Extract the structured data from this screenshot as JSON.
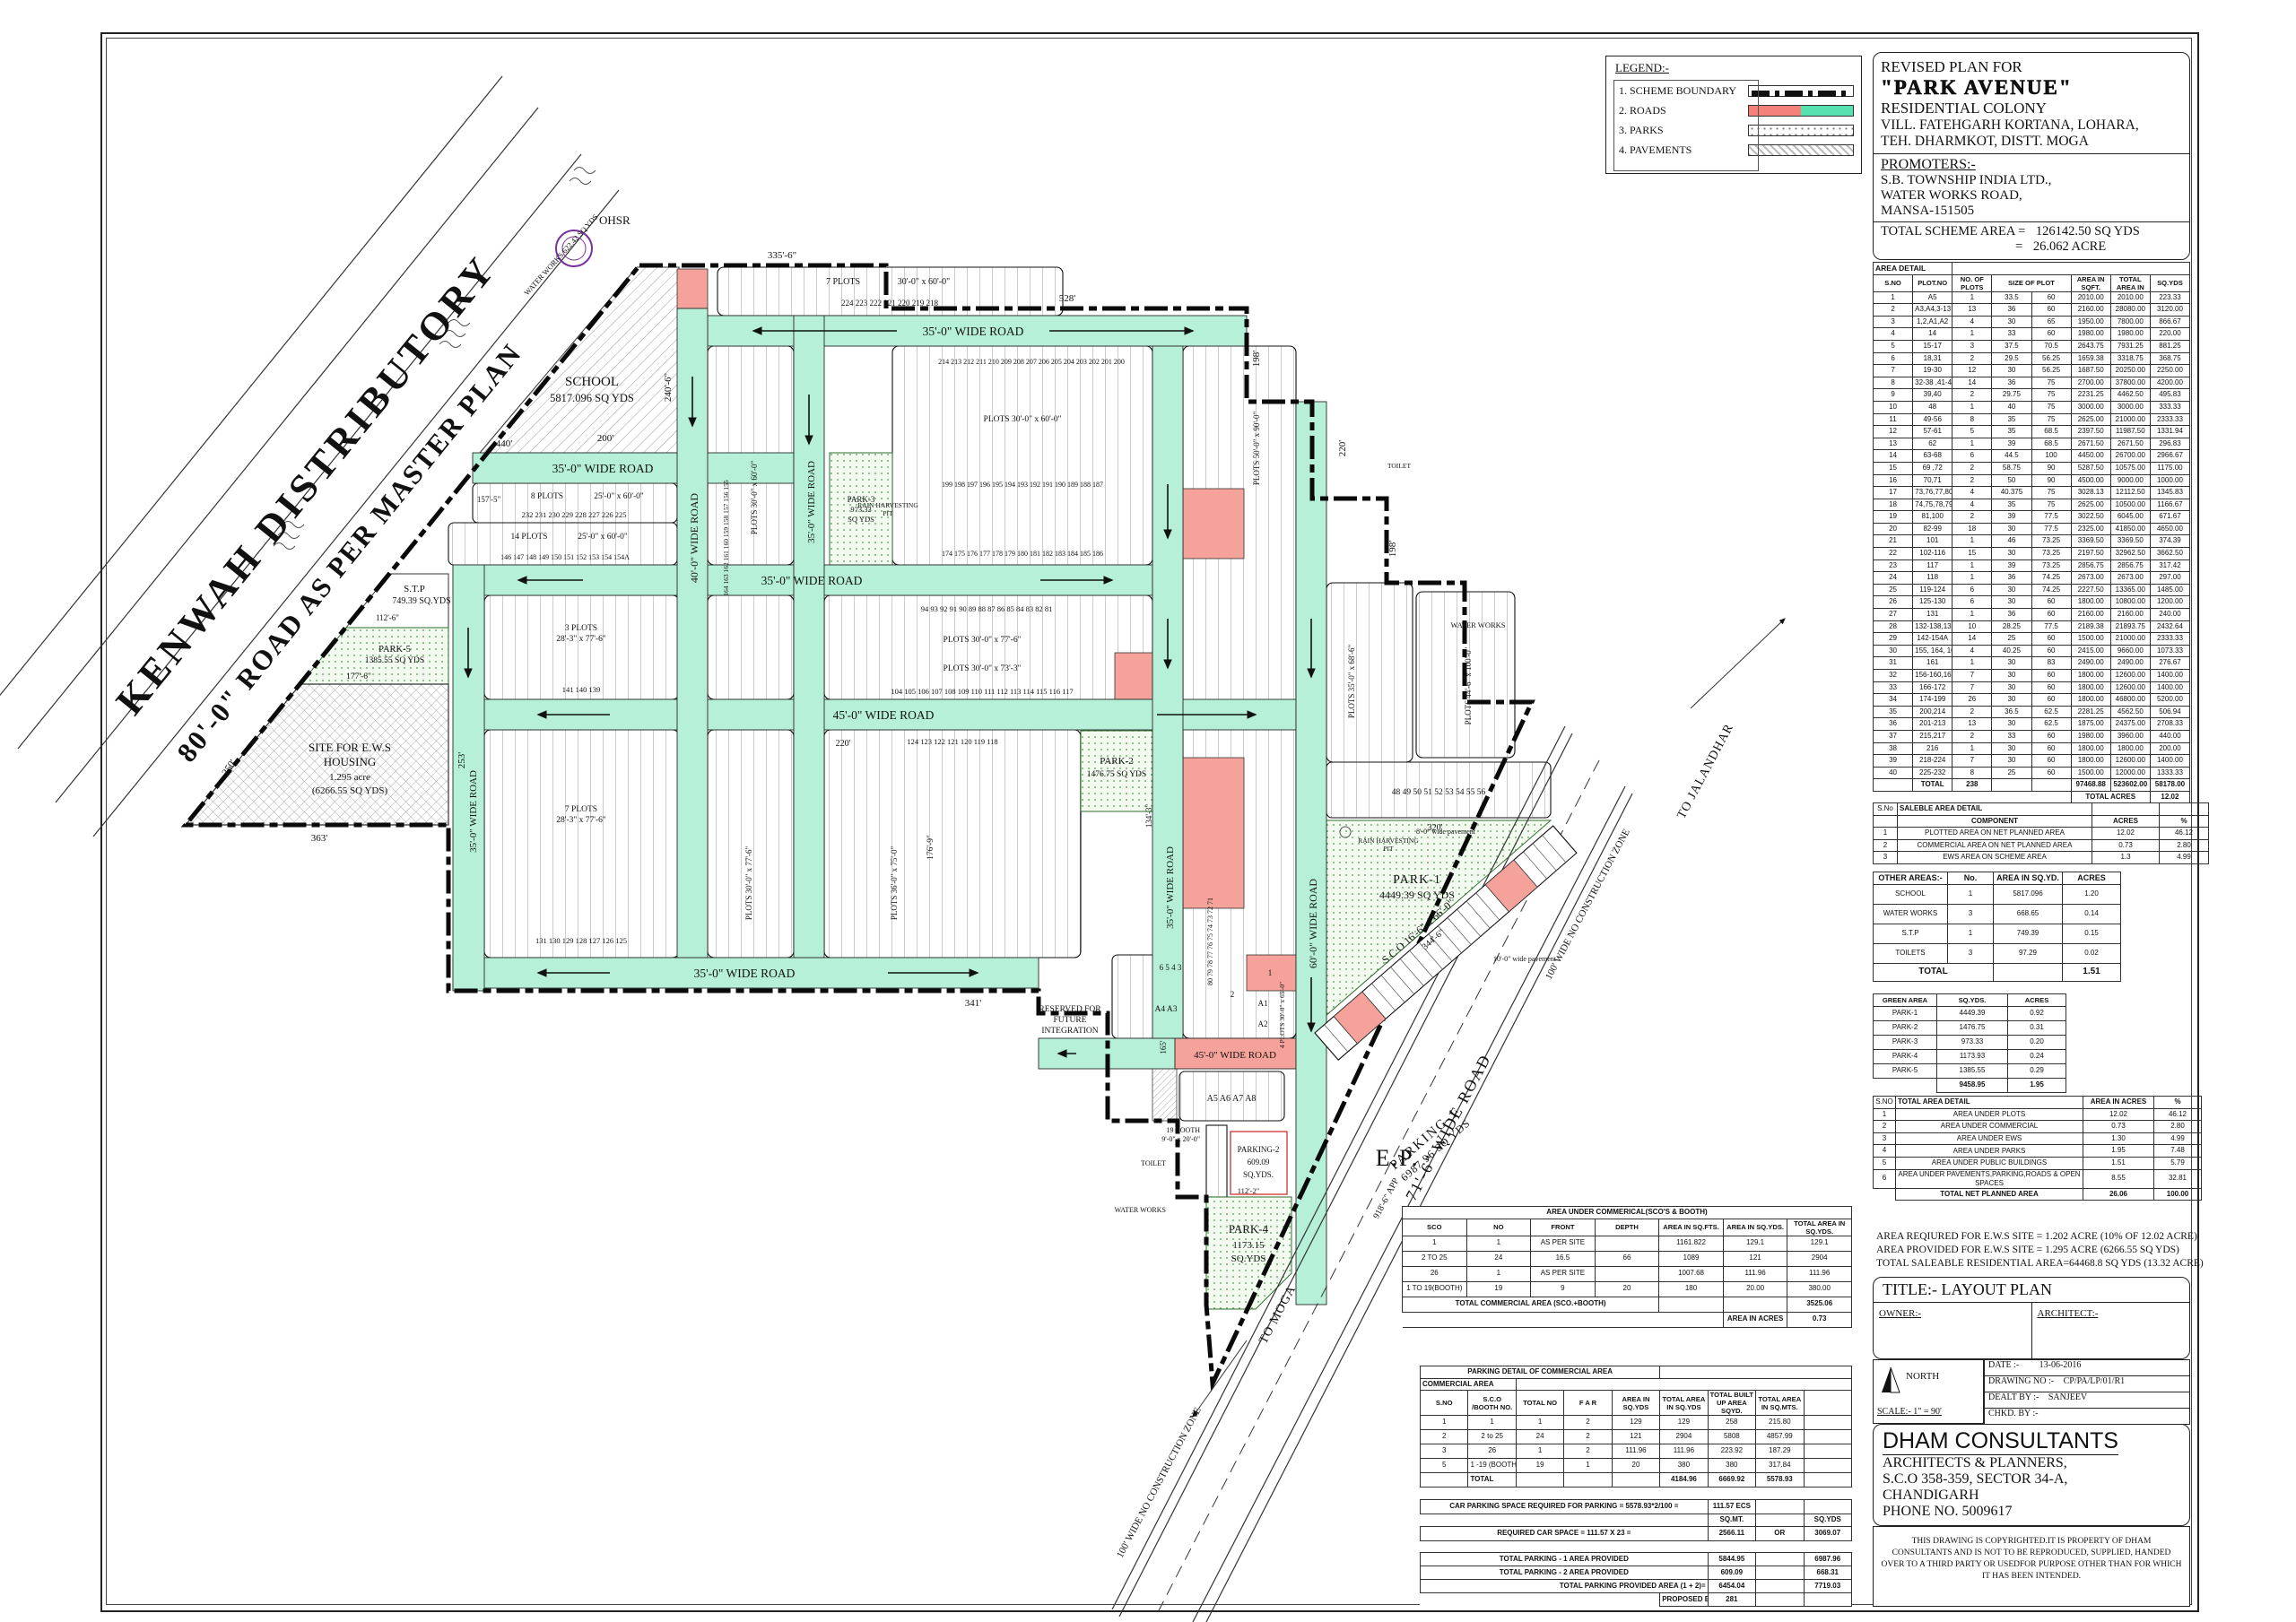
{
  "colors": {
    "road_teal": "#b6f0d9",
    "salmon": "#f4a29a",
    "park_dot": "#4d9c4d",
    "red_text": "#cc1111",
    "purple": "#7a2f9e"
  },
  "legend": {
    "title": "LEGEND:-",
    "items": [
      {
        "label": "1.  SCHEME BOUNDARY",
        "swatch": "boundary"
      },
      {
        "label": "2.  ROADS",
        "swatch": "roads"
      },
      {
        "label": "3.  PARKS",
        "swatch": "parks"
      },
      {
        "label": "4.  PAVEMENTS",
        "swatch": "pavements"
      }
    ]
  },
  "title_block": {
    "line1": "REVISED  PLAN FOR",
    "name": "\"PARK AVENUE\"",
    "line3": "RESIDENTIAL COLONY",
    "line4": "VILL. FATEHGARH KORTANA, LOHARA,",
    "line5": "TEH. DHARMKOT, DISTT. MOGA",
    "promoters_label": "PROMOTERS:-",
    "promoter1": "S.B. TOWNSHIP INDIA LTD.,",
    "promoter2": "WATER WORKS ROAD,",
    "promoter3": "MANSA-151505",
    "scheme_area_label": "TOTAL SCHEME AREA   =",
    "scheme_area_val1": "126142.50 SQ YDS",
    "scheme_area_eq": "=",
    "scheme_area_val2": "26.062 ACRE"
  },
  "area_detail": {
    "title": "AREA DETAIL",
    "headers": [
      "S.NO",
      "PLOT.NO",
      "NO. OF PLOTS",
      "SIZE OF PLOT",
      "",
      "AREA IN SQFT.",
      "TOTAL AREA IN",
      "SQ.YDS"
    ],
    "rows": [
      [
        "1",
        "A5",
        "1",
        "33.5",
        "60",
        "2010.00",
        "2010.00",
        "223.33"
      ],
      [
        "2",
        "A3,A4,3-13",
        "13",
        "36",
        "60",
        "2160.00",
        "28080.00",
        "3120.00"
      ],
      [
        "3",
        "1,2,A1,A2",
        "4",
        "30",
        "65",
        "1950.00",
        "7800.00",
        "866.67"
      ],
      [
        "4",
        "14",
        "1",
        "33",
        "60",
        "1980.00",
        "1980.00",
        "220.00"
      ],
      [
        "5",
        "15-17",
        "3",
        "37.5",
        "70.5",
        "2643.75",
        "7931.25",
        "881.25"
      ],
      [
        "6",
        "18,31",
        "2",
        "29.5",
        "56.25",
        "1659.38",
        "3318.75",
        "368.75"
      ],
      [
        "7",
        "19-30",
        "12",
        "30",
        "56.25",
        "1687.50",
        "20250.00",
        "2250.00"
      ],
      [
        "8",
        "32-38 ,41-47",
        "14",
        "36",
        "75",
        "2700.00",
        "37800.00",
        "4200.00"
      ],
      [
        "9",
        "39,40",
        "2",
        "29.75",
        "75",
        "2231.25",
        "4462.50",
        "495.83"
      ],
      [
        "10",
        "48",
        "1",
        "40",
        "75",
        "3000.00",
        "3000.00",
        "333.33"
      ],
      [
        "11",
        "49-56",
        "8",
        "35",
        "75",
        "2625.00",
        "21000.00",
        "2333.33"
      ],
      [
        "12",
        "57-61",
        "5",
        "35",
        "68.5",
        "2397.50",
        "11987.50",
        "1331.94"
      ],
      [
        "13",
        "62",
        "1",
        "39",
        "68.5",
        "2671.50",
        "2671.50",
        "296.83"
      ],
      [
        "14",
        "63-68",
        "6",
        "44.5",
        "100",
        "4450.00",
        "26700.00",
        "2966.67"
      ],
      [
        "15",
        "69 ,72",
        "2",
        "58.75",
        "90",
        "5287.50",
        "10575.00",
        "1175.00"
      ],
      [
        "16",
        "70,71",
        "2",
        "50",
        "90",
        "4500.00",
        "9000.00",
        "1000.00"
      ],
      [
        "17",
        "73,76,77,80",
        "4",
        "40.375",
        "75",
        "3028.13",
        "12112.50",
        "1345.83"
      ],
      [
        "18",
        "74,75,78,79",
        "4",
        "35",
        "75",
        "2625.00",
        "10500.00",
        "1166.67"
      ],
      [
        "19",
        "81,100",
        "2",
        "39",
        "77.5",
        "3022.50",
        "6045.00",
        "671.67"
      ],
      [
        "20",
        "82-99",
        "18",
        "30",
        "77.5",
        "2325.00",
        "41850.00",
        "4650.00"
      ],
      [
        "21",
        "101",
        "1",
        "46",
        "73.25",
        "3369.50",
        "3369.50",
        "374.39"
      ],
      [
        "22",
        "102-116",
        "15",
        "30",
        "73.25",
        "2197.50",
        "32962.50",
        "3662.50"
      ],
      [
        "23",
        "117",
        "1",
        "39",
        "73.25",
        "2856.75",
        "2856.75",
        "317.42"
      ],
      [
        "24",
        "118",
        "1",
        "36",
        "74.25",
        "2673.00",
        "2673.00",
        "297.00"
      ],
      [
        "25",
        "119-124",
        "6",
        "30",
        "74.25",
        "2227.50",
        "13365.00",
        "1485.00"
      ],
      [
        "26",
        "125-130",
        "6",
        "30",
        "60",
        "1800.00",
        "10800.00",
        "1200.00"
      ],
      [
        "27",
        "131",
        "1",
        "36",
        "60",
        "2160.00",
        "2160.00",
        "240.00"
      ],
      [
        "28",
        "132-138,139-141",
        "10",
        "28.25",
        "77.5",
        "2189.38",
        "21893.75",
        "2432.64"
      ],
      [
        "29",
        "142-154A",
        "14",
        "25",
        "60",
        "1500.00",
        "21000.00",
        "2333.33"
      ],
      [
        "30",
        "155, 164, 165, 173",
        "4",
        "40.25",
        "60",
        "2415.00",
        "9660.00",
        "1073.33"
      ],
      [
        "31",
        "161",
        "1",
        "30",
        "83",
        "2490.00",
        "2490.00",
        "276.67"
      ],
      [
        "32",
        "156-160,162,163",
        "7",
        "30",
        "60",
        "1800.00",
        "12600.00",
        "1400.00"
      ],
      [
        "33",
        "166-172",
        "7",
        "30",
        "60",
        "1800.00",
        "12600.00",
        "1400.00"
      ],
      [
        "34",
        "174-199",
        "26",
        "30",
        "60",
        "1800.00",
        "46800.00",
        "5200.00"
      ],
      [
        "35",
        "200,214",
        "2",
        "36.5",
        "62.5",
        "2281.25",
        "4562.50",
        "506.94"
      ],
      [
        "36",
        "201-213",
        "13",
        "30",
        "62.5",
        "1875.00",
        "24375.00",
        "2708.33"
      ],
      [
        "37",
        "215,217",
        "2",
        "33",
        "60",
        "1980.00",
        "3960.00",
        "440.00"
      ],
      [
        "38",
        "216",
        "1",
        "30",
        "60",
        "1800.00",
        "1800.00",
        "200.00"
      ],
      [
        "39",
        "218-224",
        "7",
        "30",
        "60",
        "1800.00",
        "12600.00",
        "1400.00"
      ],
      [
        "40",
        "225-232",
        "8",
        "25",
        "60",
        "1500.00",
        "12000.00",
        "1333.33"
      ]
    ],
    "total_label": "TOTAL",
    "total_plots": "238",
    "total_sqft": "97468.88",
    "total_area": "523602.00",
    "total_sqyds": "58178.00",
    "total_acres_label": "TOTAL ACRES",
    "total_acres": "12.02"
  },
  "saleable": {
    "sno_label": "S.No",
    "title": "SALEBLE AREA DETAIL",
    "component": "COMPONENT",
    "acres": "ACRES",
    "pct": "%",
    "rows": [
      [
        "1",
        "PLOTTED AREA ON NET PLANNED AREA",
        "12.02",
        "46.12"
      ],
      [
        "2",
        "COMMERCIAL AREA ON NET PLANNED AREA",
        "0.73",
        "2.80"
      ],
      [
        "3",
        "EWS AREA ON SCHEME AREA",
        "1.3",
        "4.99"
      ]
    ]
  },
  "other_areas": {
    "title": "OTHER AREAS:-",
    "no": "No.",
    "area": "AREA IN SQ.YD.",
    "acres": "ACRES",
    "rows": [
      [
        "SCHOOL",
        "1",
        "5817.096",
        "1.20"
      ],
      [
        "WATER WORKS",
        "3",
        "668.65",
        "0.14"
      ],
      [
        "S.T.P",
        "1",
        "749.39",
        "0.15"
      ],
      [
        "TOILETS",
        "3",
        "97.29",
        "0.02"
      ]
    ],
    "total_label": "TOTAL",
    "total": "1.51"
  },
  "green_area": {
    "headers": [
      "GREEN AREA",
      "SQ.YDS.",
      "ACRES"
    ],
    "rows": [
      [
        "PARK-1",
        "4449.39",
        "0.92"
      ],
      [
        "PARK-2",
        "1476.75",
        "0.31"
      ],
      [
        "PARK-3",
        "973.33",
        "0.20"
      ],
      [
        "PARK-4",
        "1173.93",
        "0.24"
      ],
      [
        "PARK-5",
        "1385.55",
        "0.29"
      ]
    ],
    "total_sqyds": "9458.95",
    "total_acres": "1.95"
  },
  "total_area": {
    "sno": "S.NO",
    "title": "TOTAL AREA DETAIL",
    "acres": "AREA IN ACRES",
    "pct": "%",
    "rows": [
      [
        "1",
        "AREA UNDER PLOTS",
        "12.02",
        "46.12"
      ],
      [
        "2",
        "AREA UNDER COMMERCIAL",
        "0.73",
        "2.80"
      ],
      [
        "3",
        "AREA UNDER EWS",
        "1.30",
        "4.99"
      ],
      [
        "4",
        "AREA UNDER PARKS",
        "1.95",
        "7.48"
      ],
      [
        "5",
        "AREA UNDER PUBLIC BUILDINGS",
        "1.51",
        "5.79"
      ],
      [
        "6",
        "AREA UNDER PAVEMENTS,PARKING,ROADS & OPEN SPACES",
        "8.55",
        "32.81"
      ]
    ],
    "total_label": "TOTAL NET PLANNED AREA",
    "total_acres": "26.06",
    "total_pct": "100.00"
  },
  "ews_notes": [
    "AREA REQIURED FOR E.W.S SITE = 1.202 ACRE (10% OF 12.02 ACRE)",
    "AREA PROVIDED FOR E.W.S SITE = 1.295 ACRE (6266.55 SQ YDS)",
    "TOTAL SALEABLE RESIDENTIAL AREA=64468.8 SQ YDS (13.32 ACRE)"
  ],
  "title_plate": {
    "title": "TITLE:-  LAYOUT   PLAN",
    "owner": "OWNER:-",
    "architect": "ARCHITECT:-"
  },
  "info": {
    "north": "NORTH",
    "scale": "SCALE:-  1\" = 90'",
    "date_label": "DATE :-",
    "date": "13-06-2016",
    "dwg_label": "DRAWING NO :-",
    "dwg": "CP/PA/LP/01/R1",
    "dealt_label": "DEALT BY :-",
    "dealt": "SANJEEV",
    "chkd_label": "CHKD. BY :-",
    "chkd": ""
  },
  "firm": {
    "name": "DHAM CONSULTANTS",
    "line2": "ARCHITECTS & PLANNERS,",
    "line3": "S.C.O 358-359, SECTOR 34-A,",
    "line4": "CHANDIGARH",
    "line5": "PHONE NO. 5009617"
  },
  "copyright": "THIS DRAWING IS COPYRIGHTED.IT IS PROPERTY OF DHAM CONSULTANTS AND IS NOT TO BE REPRODUCED, SUPPLIED, HANDED OVER TO A THIRD PARTY OR USEDFOR PURPOSE OTHER THAN FOR WHICH IT HAS BEEN INTENDED.",
  "commercial_table": {
    "title": "AREA UNDER COMMERICAL(SCO'S & BOOTH)",
    "headers": [
      "SCO",
      "NO",
      "FRONT",
      "DEPTH",
      "AREA IN SQ.FTS.",
      "AREA IN SQ.YDS.",
      "TOTAL AREA IN SQ.YDS."
    ],
    "rows": [
      [
        "1",
        "1",
        "AS PER SITE",
        "",
        "1161.822",
        "129.1",
        "129.1"
      ],
      [
        "2 TO 25",
        "24",
        "16.5",
        "66",
        "1089",
        "121",
        "2904"
      ],
      [
        "26",
        "1",
        "AS PER SITE",
        "",
        "1007.68",
        "111.96",
        "111.96"
      ],
      [
        "1  TO 19(BOOTH)",
        "19",
        "9",
        "20",
        "180",
        "20.00",
        "380.00"
      ]
    ],
    "total_label": "TOTAL COMMERCIAL AREA (SCO.+BOOTH)",
    "total": "3525.06",
    "acres_label": "AREA IN ACRES",
    "acres": "0.73"
  },
  "parking_table": {
    "title": "PARKING DETAIL OF COMMERCIAL AREA",
    "subtitle": "COMMERCIAL AREA",
    "headers": [
      "S.NO",
      "S.C.O /BOOTH NO.",
      "TOTAL NO",
      "F A R",
      "AREA IN SQ.YDS",
      "TOTAL AREA IN SQ.YDS",
      "TOTAL BUILT UP AREA SQYD.",
      "TOTAL AREA IN SQ.MTS.",
      ""
    ],
    "rows": [
      [
        "1",
        "1",
        "1",
        "2",
        "129",
        "129",
        "258",
        "215.80",
        ""
      ],
      [
        "2",
        "2 to 25",
        "24",
        "2",
        "121",
        "2904",
        "5808",
        "4857.99",
        ""
      ],
      [
        "3",
        "26",
        "1",
        "2",
        "111.96",
        "111.96",
        "223.92",
        "187.29",
        ""
      ],
      [
        "5",
        "1 -19 (BOOTH)",
        "19",
        "1",
        "20",
        "380",
        "380",
        "317.84",
        ""
      ]
    ],
    "total_label": "TOTAL",
    "total_area": "4184.96",
    "total_builtup": "6669.92",
    "total_sqmts": "5578.93",
    "car_label": "CAR PARKING SPACE REQUIRED FOR PARKING = 5578.93*2/100 =",
    "car_val": "111.57 ECS",
    "sqmt": "SQ.MT.",
    "sqyds": "SQ.YDS",
    "req_label": "REQUIRED CAR SPACE = 111.57 X 23 =",
    "req_val": "2566.11",
    "or": "OR",
    "req_val2": "3069.07",
    "p1_label": "TOTAL PARKING - 1 AREA PROVIDED",
    "p1_a": "5844.95",
    "p1_b": "6987.96",
    "p2_label": "TOTAL PARKING - 2 AREA PROVIDED",
    "p2_a": "609.09",
    "p2_b": "668.31",
    "pt_label": "TOTAL PARKING PROVIDED  AREA (1 + 2)=",
    "pt_a": "6454.04",
    "pt_b": "7719.03",
    "ecs_label": "PROPOSED E.C.S",
    "ecs": "281"
  },
  "map": {
    "kenwah1": "KENWAH DISTRIBUTORY",
    "kenwah2": "80'-0\" ROAD AS PER MASTER PLAN",
    "ohsr": "OHSR",
    "ww_small": "WATER WORKS 622.42 SQ YDS",
    "school1": "SCHOOL",
    "school2": "5817.096 SQ YDS",
    "stp1": "S.T.P",
    "stp2": "749.39 SQ.YDS",
    "park5_1": "PARK-5",
    "park5_2": "1385.55 SQ YDS",
    "ews1": "SITE FOR E.W.S",
    "ews2": "HOUSING",
    "ews3": "1.295 acre",
    "ews4": "(6266.55 SQ YDS)",
    "park3_1": "PARK-3",
    "park3_2": "973.33",
    "park3_3": "SQ YDS",
    "park2_1": "PARK-2",
    "park2_2": "1476.75 SQ YDS",
    "park1_1": "PARK-1",
    "park1_2": "4449.39 SQ YDS",
    "park4_1": "PARK-4",
    "park4_2": "1173.15",
    "park4_3": "SQ.YDS",
    "parking1_1": "PARKING-1",
    "parking1_2": "6987.96 SQ YDS",
    "parking2_1": "PARKING-2",
    "parking2_2": "609.09",
    "parking2_3": "SQ.YDS.",
    "rain1": "RAIN HARVESTING",
    "rain2": "PIT",
    "road35": "35'-0\" WIDE ROAD",
    "road40": "40'-0\" WIDE ROAD",
    "road45": "45'-0\" WIDE ROAD",
    "road60": "60'-0\" WIDE ROAD",
    "road71": "71'-6\" WIDE ROAD",
    "ncz": "100' WIDE NO CONSTRUCTION ZONE",
    "to_jal": "TO JALANDHAR",
    "to_moga": "TO MOGA",
    "ep": "E.P.",
    "res1": "RESERVED FOR",
    "res2": "FUTURE",
    "res3": "INTEGRATION",
    "sco_label": "S C O   16'-6\" x 66'-0\"",
    "booth1": "19 BOOTH",
    "booth2": "9'-0\" x 20'-0\"",
    "toilet": "TOILET",
    "water_works": "WATER WORKS",
    "b1": "7 PLOTS",
    "b1s": "30'-0\" x 60'-0\"",
    "b2": "8 PLOTS",
    "b2s": "25'-0\" x 60'-0\"",
    "b3": "14 PLOTS",
    "b3s": "25'-0\" x 60'-0\"",
    "b4": "3 PLOTS",
    "b4s": "28'-3\" x 77'-6\"",
    "b5": "7 PLOTS",
    "b5s": "28'-3\" x 77'-6\"",
    "bp1": "PLOTS 30'-0\" x 60'-0\"",
    "bp2": "PLOTS 30'-0\" x 77'-6\"",
    "bp3": "PLOTS 30'-0\" x 73'-3\"",
    "bp4": "PLOTS 36'-0\" x 75'-0\"",
    "bp5": "4 PLOTS 30'-0\" x 65'-0\"",
    "bp6": "PLOTS 50'-0\" x 90'-0\"",
    "bp7": "PLOTS 35'-0\" x 68'-6\"",
    "bp8": "PLOTS 44'-6\" x 100'-0\"",
    "pav8": "8'-0\" wide pavement",
    "pav10": "10'-0\" wide pavement",
    "nums": {
      "n218": "224   223   222   221   220   219   218",
      "n225": "232   231   230   229   228   227   226   225",
      "n142": "146  147  148  149  150  151  152  153  154  154A",
      "n174": "174  175  176  177  178  179  180  181  182  183  184  185  186",
      "n199": "199  198  197  196  195  194  193  192  191  190  189  188  187",
      "n201": "214  213  212  211  210  209  208  207  206  205  204  203  202  201  200",
      "n81": "94   93   92   91   90   89   88   87   86   85   84   83   82   81",
      "n104": "104  105  106  107  108  109  110  111  112  113  114  115  116  117",
      "n118": "124    123    122    121    120    119    118",
      "n48": "48    49    50    51    52    53    54    55    56",
      "n71": "80   79   78   77   76   75   74   73   72   71",
      "nA": "A5     A6     A7     A8",
      "n6": "6    5    4    3",
      "n2": "2",
      "n1": "1",
      "nA43": "A4    A3",
      "a1": "A1",
      "a2": "A2",
      "n139": "141   140   139",
      "n132": "138   137   136   135   134   133   132",
      "n125": "131   130   129   128   127   126   125",
      "n155": "164  163  162  161  160  159  158  157  156  155"
    },
    "dims": {
      "d335": "335'-6\"",
      "d528": "528'",
      "d198": "198'",
      "d220": "220'",
      "d240": "240'-6\"",
      "d200": "200'",
      "d363": "363'",
      "d253": "253'",
      "d250": "250'",
      "d341": "341'",
      "d165": "165'",
      "d918": "918'-6\" APP",
      "d320": "320'",
      "d344": "344'-6\"",
      "d112": "112'-2\"",
      "d177": "177'-6\"",
      "d1126": "112'-6\"",
      "d157": "157'-5\"",
      "d176": "176'-9\"",
      "d134": "134'-3\"",
      "d440": "440'"
    }
  }
}
